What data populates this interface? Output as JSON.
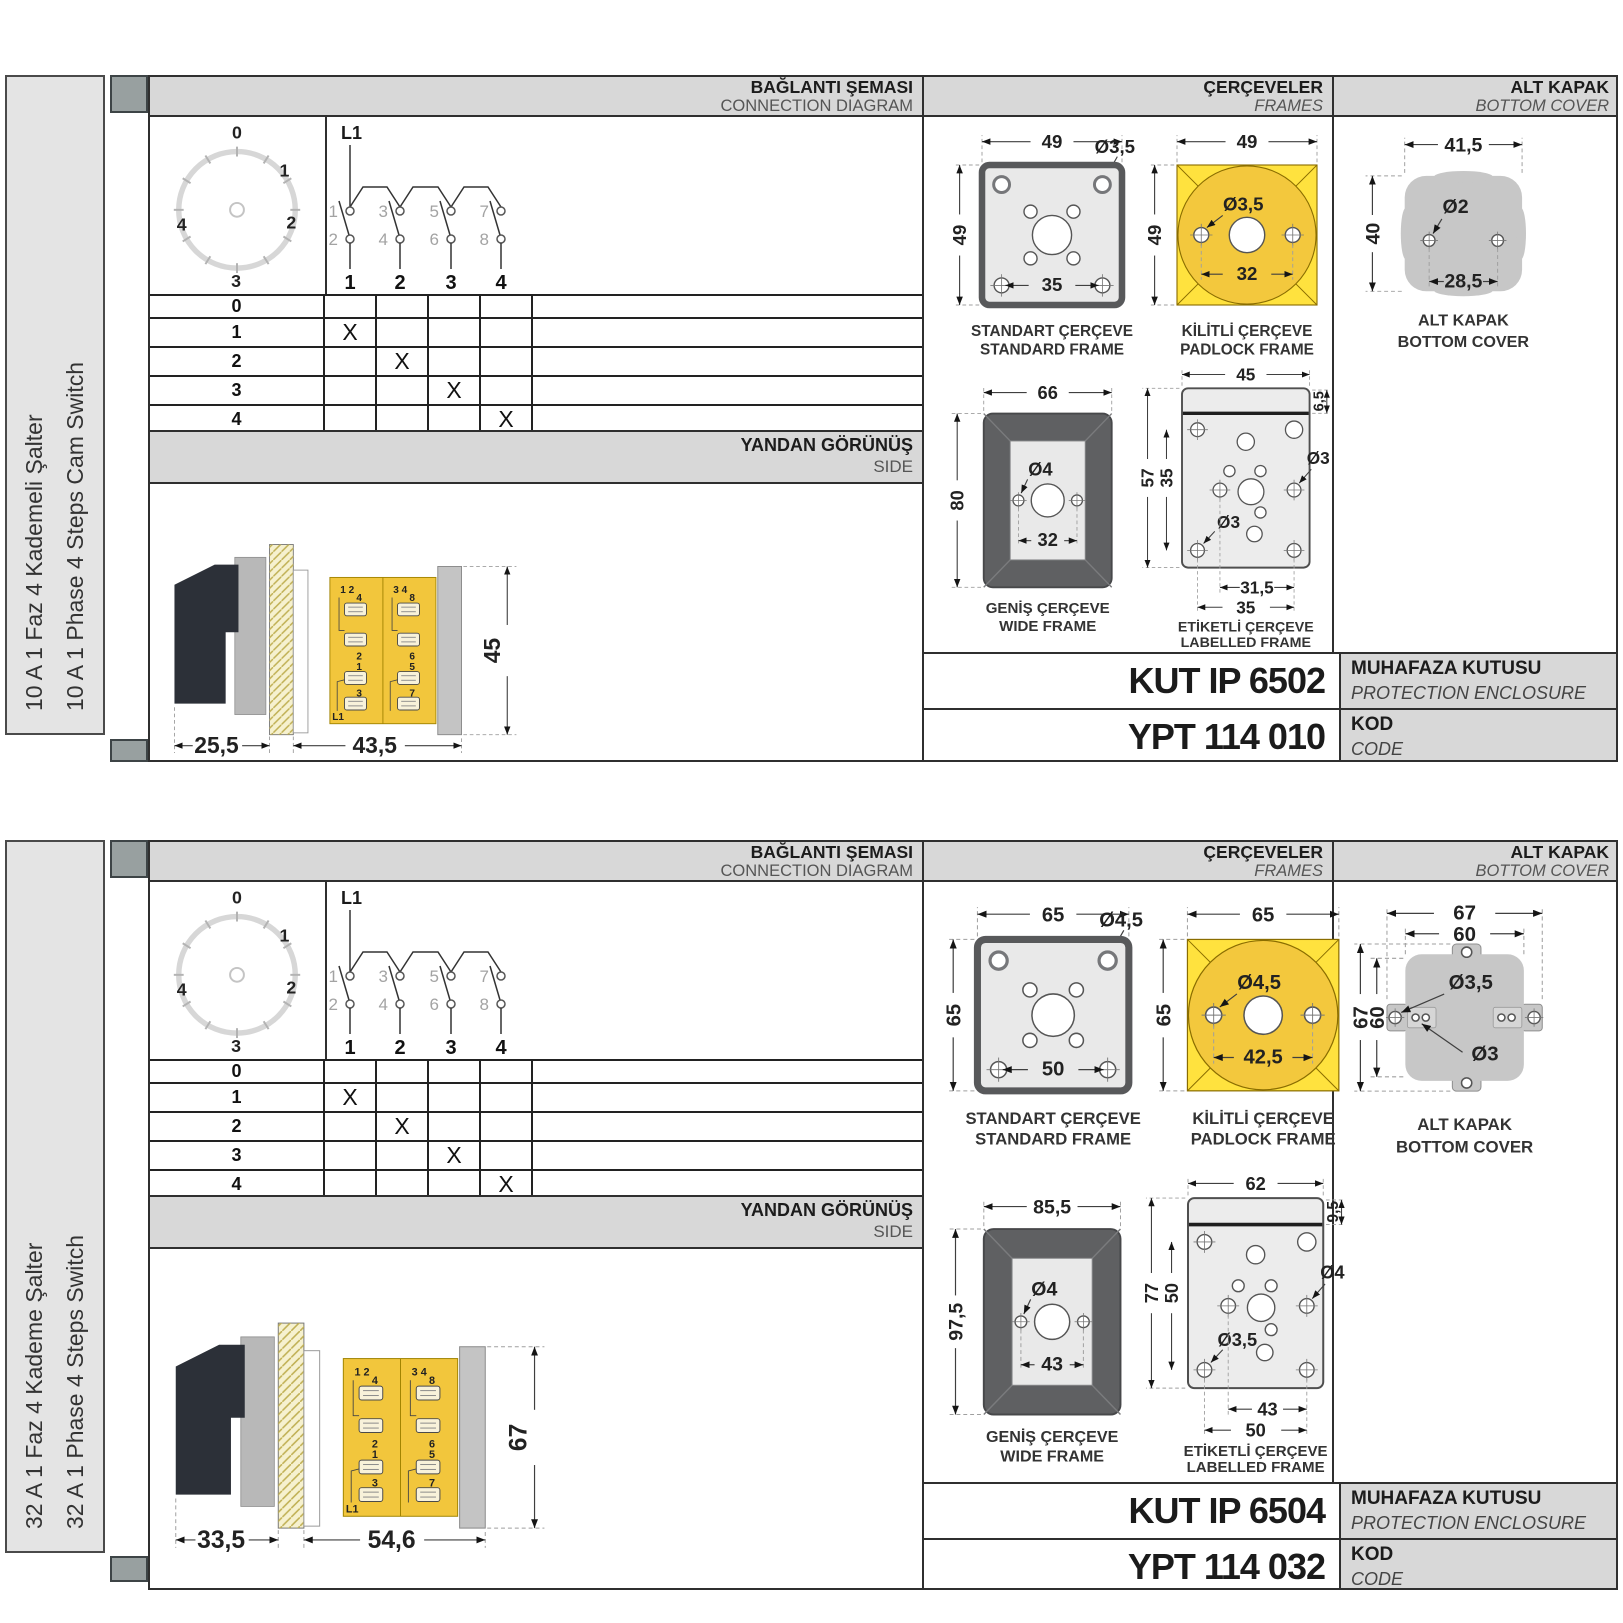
{
  "colors": {
    "cam_yellow": "#F2C63C",
    "padlock_yellow": "#FFE23E",
    "header_grey": "#D8D8D8",
    "frame_dark_grey": "#5F6062",
    "cover_grey": "#C7C7C7",
    "hatch_cream": "#F6F1CF"
  },
  "blocks": [
    {
      "side_label_tr": "10 A 1 Faz 4 Kademeli Şalter",
      "side_label_en": "10 A 1 Phase 4 Steps Cam Switch",
      "headers": {
        "connection_tr": "BAĞLANTI ŞEMASI",
        "connection_en": "CONNECTION DIAGRAM",
        "frames_tr": "ÇERÇEVELER",
        "frames_en": "FRAMES",
        "cover_tr": "ALT KAPAK",
        "cover_en": "BOTTOM COVER"
      },
      "dial": {
        "positions": [
          "0",
          "1",
          "2",
          "3",
          "4"
        ]
      },
      "circuit": {
        "input": "L1",
        "top": [
          "1",
          "3",
          "5",
          "7"
        ],
        "bottom": [
          "2",
          "4",
          "6",
          "8"
        ],
        "outputs": [
          "1",
          "2",
          "3",
          "4"
        ]
      },
      "table": {
        "rows": [
          [
            "0",
            "",
            "",
            "",
            ""
          ],
          [
            "1",
            "X",
            "",
            "",
            ""
          ],
          [
            "2",
            "",
            "X",
            "",
            ""
          ],
          [
            "3",
            "",
            "",
            "X",
            ""
          ],
          [
            "4",
            "",
            "",
            "",
            "X"
          ]
        ]
      },
      "side_view": {
        "title_tr": "YANDAN GÖRÜNÜŞ",
        "title_en": "SIDE",
        "front_depth": "25,5",
        "body_depth": "43,5",
        "height": "45",
        "labels": {
          "pair1": "1 2",
          "pair2": "3 4",
          "t1": "4",
          "t2": "8",
          "t3": "2",
          "t4": "6",
          "t5": "1",
          "t6": "5",
          "t7": "3",
          "t8": "7",
          "input": "L1"
        }
      },
      "frames": {
        "standard": {
          "caption_tr": "STANDART ÇERÇEVE",
          "caption_en": "STANDARD FRAME",
          "width": "49",
          "height": "49",
          "hole": "Ø3,5",
          "span": "35"
        },
        "padlock": {
          "caption_tr": "KİLİTLİ ÇERÇEVE",
          "caption_en": "PADLOCK FRAME",
          "width": "49",
          "height": "49",
          "hole": "Ø3,5",
          "span": "32"
        },
        "wide": {
          "caption_tr": "GENİŞ ÇERÇEVE",
          "caption_en": "WIDE FRAME",
          "width": "66",
          "height": "80",
          "hole": "Ø4",
          "span": "32"
        },
        "labelled": {
          "caption_tr": "ETİKETLİ ÇERÇEVE",
          "caption_en": "LABELLED FRAME",
          "width": "45",
          "strip": "6,5",
          "height": "57",
          "inner_height": "35",
          "hole_right": "Ø3",
          "hole_bottom": "Ø3",
          "span_inner": "31,5",
          "span_outer": "35"
        }
      },
      "cover": {
        "caption_tr": "ALT KAPAK",
        "caption_en": "BOTTOM COVER",
        "width": "41,5",
        "height": "40",
        "hole": "Ø2",
        "span": "28,5"
      },
      "enclosure": {
        "code": "KUT IP 6502",
        "label_tr": "MUHAFAZA KUTUSU",
        "label_en": "PROTECTION ENCLOSURE"
      },
      "code": {
        "value": "YPT 114 010",
        "label_tr": "KOD",
        "label_en": "CODE"
      }
    },
    {
      "side_label_tr": "32 A 1 Faz 4 Kademe Şalter",
      "side_label_en": "32 A 1 Phase 4 Steps Switch",
      "headers": {
        "connection_tr": "BAĞLANTI ŞEMASI",
        "connection_en": "CONNECTION DIAGRAM",
        "frames_tr": "ÇERÇEVELER",
        "frames_en": "FRAMES",
        "cover_tr": "ALT KAPAK",
        "cover_en": "BOTTOM COVER"
      },
      "dial": {
        "positions": [
          "0",
          "1",
          "2",
          "3",
          "4"
        ]
      },
      "circuit": {
        "input": "L1",
        "top": [
          "1",
          "3",
          "5",
          "7"
        ],
        "bottom": [
          "2",
          "4",
          "6",
          "8"
        ],
        "outputs": [
          "1",
          "2",
          "3",
          "4"
        ]
      },
      "table": {
        "rows": [
          [
            "0",
            "",
            "",
            "",
            ""
          ],
          [
            "1",
            "X",
            "",
            "",
            ""
          ],
          [
            "2",
            "",
            "X",
            "",
            ""
          ],
          [
            "3",
            "",
            "",
            "X",
            ""
          ],
          [
            "4",
            "",
            "",
            "",
            "X"
          ]
        ]
      },
      "side_view": {
        "title_tr": "YANDAN GÖRÜNÜŞ",
        "title_en": "SIDE",
        "front_depth": "33,5",
        "body_depth": "54,6",
        "height": "67",
        "labels": {
          "pair1": "1 2",
          "pair2": "3 4",
          "t1": "4",
          "t2": "8",
          "t3": "2",
          "t4": "6",
          "t5": "1",
          "t6": "5",
          "t7": "3",
          "t8": "7",
          "input": "L1"
        }
      },
      "frames": {
        "standard": {
          "caption_tr": "STANDART ÇERÇEVE",
          "caption_en": "STANDARD FRAME",
          "width": "65",
          "height": "65",
          "hole": "Ø4,5",
          "span": "50"
        },
        "padlock": {
          "caption_tr": "KİLİTLİ ÇERÇEVE",
          "caption_en": "PADLOCK FRAME",
          "width": "65",
          "height": "65",
          "hole": "Ø4,5",
          "span": "42,5"
        },
        "wide": {
          "caption_tr": "GENİŞ ÇERÇEVE",
          "caption_en": "WIDE FRAME",
          "width": "85,5",
          "height": "97,5",
          "hole": "Ø4",
          "span": "43"
        },
        "labelled": {
          "caption_tr": "ETİKETLİ ÇERÇEVE",
          "caption_en": "LABELLED FRAME",
          "width": "62",
          "strip": "9,5",
          "height": "77",
          "inner_height": "50",
          "hole_right": "Ø4",
          "hole_bottom": "Ø3,5",
          "span_inner": "43",
          "span_outer": "50"
        }
      },
      "cover": {
        "caption_tr": "ALT KAPAK",
        "caption_en": "BOTTOM COVER",
        "width_outer": "67",
        "width_inner": "60",
        "height_outer": "67",
        "height_inner": "60",
        "hole_tab": "Ø3,5",
        "hole_small": "Ø3"
      },
      "enclosure": {
        "code": "KUT IP 6504",
        "label_tr": "MUHAFAZA KUTUSU",
        "label_en": "PROTECTION ENCLOSURE"
      },
      "code": {
        "value": "YPT 114 032",
        "label_tr": "KOD",
        "label_en": "CODE"
      }
    }
  ]
}
